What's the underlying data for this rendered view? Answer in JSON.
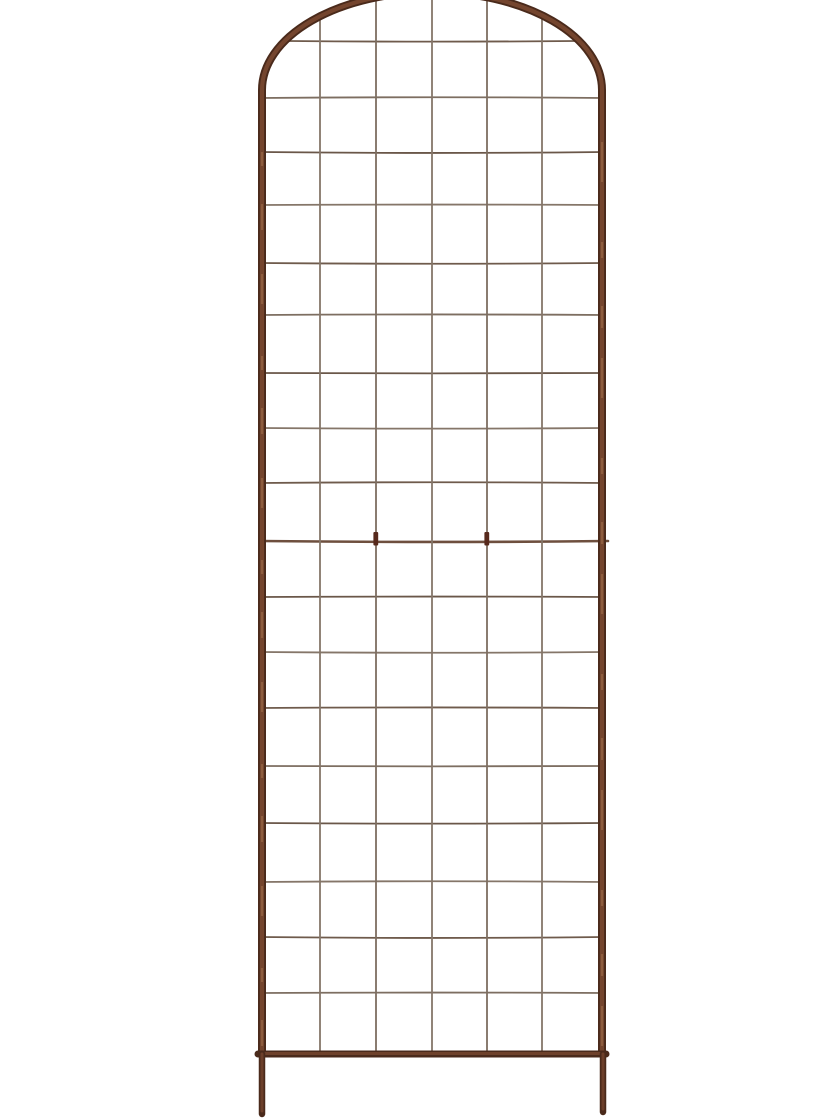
{
  "photo": {
    "subject": "arched-wire-grid-garden-trellis",
    "background_color": "#ffffff"
  },
  "trellis": {
    "frame_color_dark": "#4a2a1b",
    "frame_color_mid": "#74452e",
    "frame_color_light": "#a2714f",
    "wire_colors": [
      "#7d6e61",
      "#6f5b4c",
      "#857669",
      "#6a5749"
    ],
    "joint_wire_color": "#6e4f3e",
    "clip_color": "#57291c",
    "columns": 6,
    "grid": {
      "vertical_x": [
        320,
        376,
        432,
        487,
        542
      ],
      "horizontal_y": [
        41,
        98,
        152,
        205,
        263,
        315,
        373,
        428,
        483,
        541,
        597,
        652,
        708,
        766,
        823,
        882,
        937,
        993
      ],
      "joint_y": 541,
      "clip_x": [
        376,
        487
      ],
      "wire_width": 1.8,
      "joint_wire_width": 2.6
    },
    "frame": {
      "left_rail_x": 262,
      "right_rail_x": 602,
      "arch_center_x": 432,
      "arch_center_y": 90,
      "arch_rx": 170,
      "arch_ry": 98,
      "tube_width": 8,
      "bottom_bar_x1": 258,
      "bottom_bar_x2": 606,
      "bottom_bar_y": 1054,
      "left_leg_bottom_y": 1114,
      "right_leg_bottom_y": 1112
    }
  }
}
